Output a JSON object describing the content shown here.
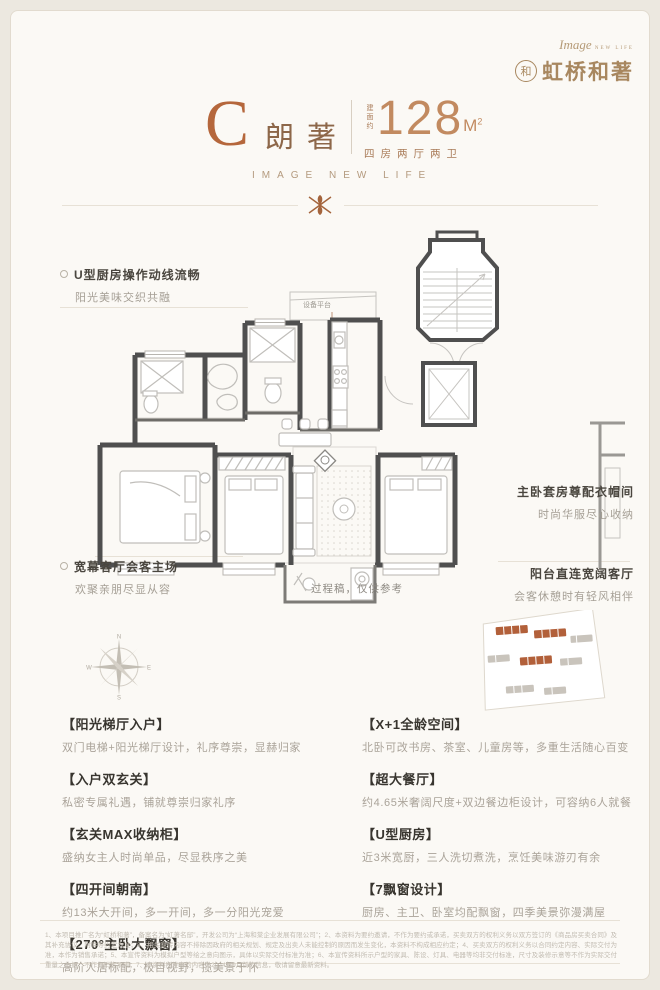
{
  "logo": {
    "script": "Image",
    "script_sub": "NEW LIFE",
    "monogram": "和",
    "brand": "虹桥和著"
  },
  "title": {
    "letter": "C",
    "name": "朗著",
    "area_prefix": "建面约",
    "area": "128",
    "area_unit": "M",
    "area_sup": "2",
    "layout": "四房两厅两卫",
    "tagline": "IMAGE NEW LIFE"
  },
  "plan": {
    "platform_label": "设备平台",
    "draft_note": "过程稿，仅供参考"
  },
  "compass": {
    "n": "N",
    "e": "E",
    "s": "S",
    "w": "W"
  },
  "annotations": {
    "left": [
      {
        "title": "U型厨房操作动线流畅",
        "desc": "阳光美味交织共融"
      },
      {
        "title": "宽幕客厅会客主场",
        "desc": "欢聚亲朋尽显从容"
      }
    ],
    "right": [
      {
        "title": "主卧套房尊配衣帽间",
        "desc": "时尚华服尽心收纳"
      },
      {
        "title": "阳台直连宽阔客厅",
        "desc": "会客休憩时有轻风相伴"
      }
    ]
  },
  "features": {
    "left": [
      {
        "t": "【阳光梯厅入户】",
        "d": "双门电梯+阳光梯厅设计，礼序尊崇，显赫归家"
      },
      {
        "t": "【入户双玄关】",
        "d": "私密专属礼遇，铺就尊崇归家礼序"
      },
      {
        "t": "【玄关MAX收纳柜】",
        "d": "盛纳女主人时尚单品，尽显秩序之美"
      },
      {
        "t": "【四开间朝南】",
        "d": "约13米大开间，多一开间，多一分阳光宠爱"
      },
      {
        "t": "【270°主卧大飘窗】",
        "d": "高阶人居标配，极目视野，揽美景于怀"
      }
    ],
    "right": [
      {
        "t": "【X+1全龄空间】",
        "d": "北卧可改书房、茶室、儿童房等，多重生活随心百变"
      },
      {
        "t": "【超大餐厅】",
        "d": "约4.65米奢阔尺度+双边餐边柜设计，可容纳6人就餐"
      },
      {
        "t": "【U型厨房】",
        "d": "近3米宽厨，三人洗切煮洗，烹饪美味游刃有余"
      },
      {
        "t": "【7飘窗设计】",
        "d": "厨房、主卫、卧室均配飘窗，四季美景弥漫满屋"
      }
    ]
  },
  "disclaimer": {
    "text": "1、本项目推广名为“虹桥和著”，备案名为“虹著名邸”，开发公司为“上海和棠企业发展有限公司”；2、本资料为要约邀请，不作为要约或承诺，买卖双方的权利义务以双方签订的《商品房买卖合同》及其补充协议、附件等约定为准；3、相关宣传内容不排除因政府的相关规划、规定及出卖人未能控制的原因而发生变化，本资料不构成相应约定；4、买卖双方的权利义务以合同约定内容、实际交付为准，本作为销售承诺；5、本宣传资料为模拟户型等绘之意向图示，具体以实际交付标准为准；6、本宣传资料所示户型的家具、陈设、灯具、电器等均非交付标准，尺寸及装修示意等不作为实际交付重量之依据，不作为销售承诺；7、本资料所发布的内容为2024年9月前的信息，敬请留意最新资料。"
  },
  "colors": {
    "accent_terracotta": "#b5673c",
    "bronze": "#a8875f",
    "wall_gray": "#4f4f4f",
    "background": "#fbf9f5"
  }
}
